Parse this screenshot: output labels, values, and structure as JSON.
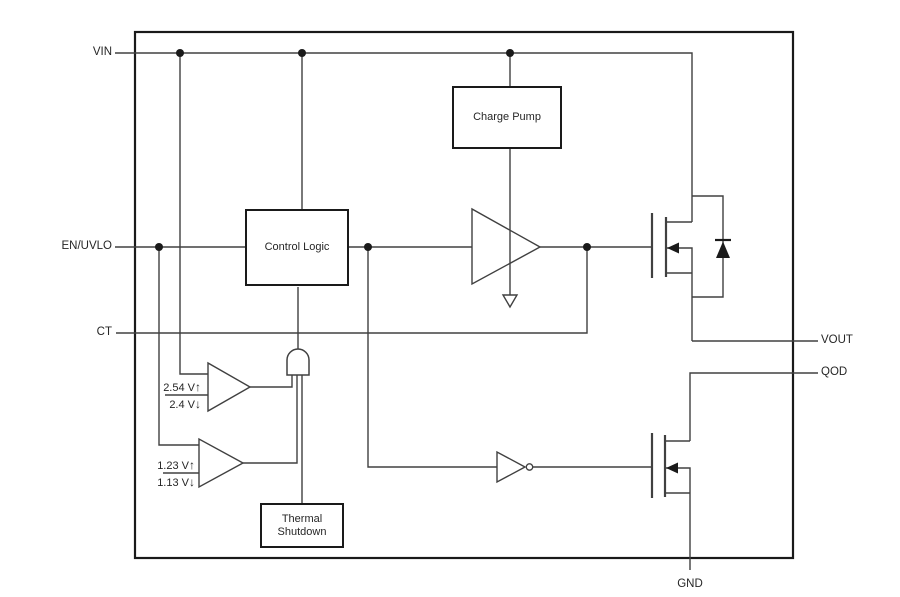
{
  "diagram": {
    "pins": {
      "vin": "VIN",
      "en_uvlo": "EN/UVLO",
      "ct": "CT",
      "vout": "VOUT",
      "qod": "QOD",
      "gnd": "GND"
    },
    "blocks": {
      "charge_pump": "Charge Pump",
      "control_logic": "Control Logic",
      "thermal_shutdown_line1": "Thermal",
      "thermal_shutdown_line2": "Shutdown"
    },
    "comparators": {
      "vin_uvlo": {
        "rising": "2.54 V",
        "falling": "2.4 V"
      },
      "en_uvlo": {
        "rising": "1.23 V",
        "falling": "1.13 V"
      }
    },
    "glyphs": {
      "rising_arrow": "↑",
      "falling_arrow": "↓"
    },
    "colors": {
      "wire": "#404040",
      "border": "#1a1a1a",
      "background": "#ffffff"
    }
  }
}
